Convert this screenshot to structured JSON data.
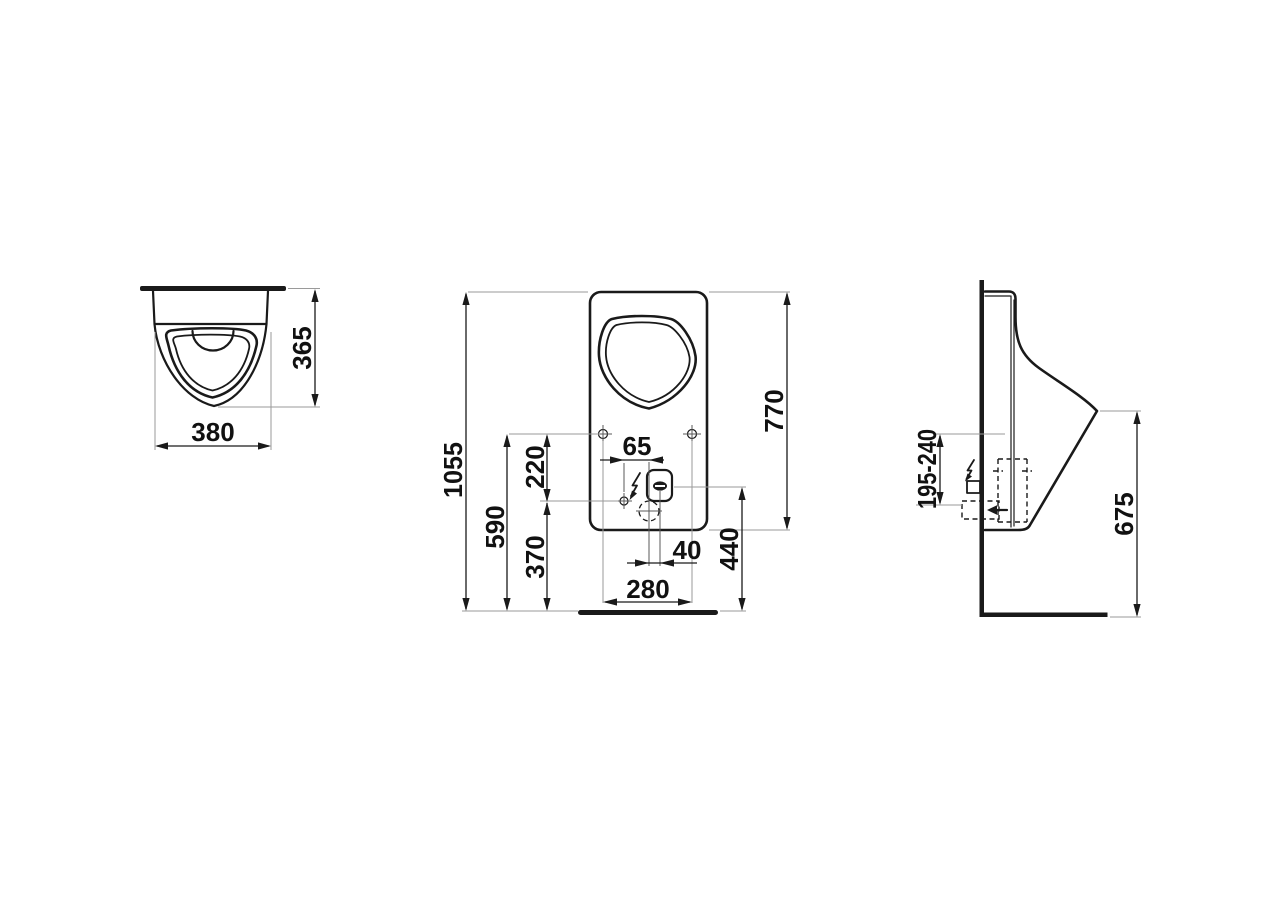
{
  "drawing": {
    "type": "sanitary-ware installation drawing, urinal, three orthographic views",
    "colors": {
      "line": "#1a1a1a",
      "extension_line": "#9a9a9a",
      "background": "#ffffff"
    },
    "dimensions": {
      "top_view": {
        "width": "380",
        "depth": "365"
      },
      "front_view": {
        "overall_height": "1055",
        "body_height": "770",
        "fixing_height": "590",
        "fixing_to_inlet": "220",
        "inlet_height": "370",
        "inlet_to_drain": "65",
        "drain_to_spout": "40",
        "fixing_spacing": "280",
        "spout_height": "440"
      },
      "side_view": {
        "inlet_depth_range": "195-240",
        "rim_height": "675"
      }
    },
    "icons": {
      "electric_flash": "lightning-bolt",
      "water_inlet": "left-arrow",
      "fixing_hole": "crosshair",
      "drain_outlet": "dashed-circle"
    }
  }
}
